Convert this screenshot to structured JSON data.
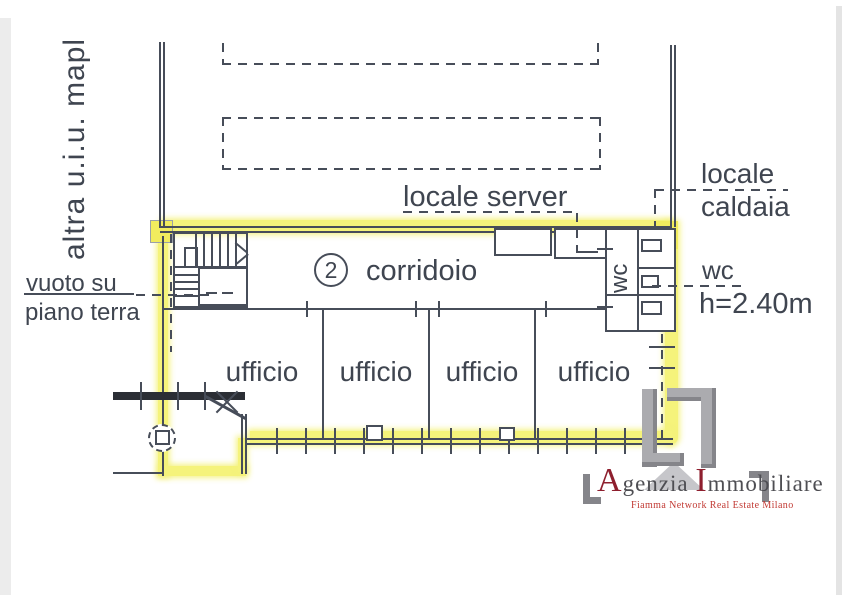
{
  "colors": {
    "highlight": "#f5f37b",
    "line": "#474d59",
    "logo_red": "#8e1f2e",
    "logo_sub": "#c23a34"
  },
  "plan": {
    "side_label": "altra u.i.u. mapl",
    "vuoto_line1": "vuoto su",
    "vuoto_line2": "piano terra",
    "locale_server_label": "locale server",
    "locale_caldaia_line1": "locale",
    "locale_caldaia_line2": "caldaia",
    "corridor_number": "2",
    "corridor_label": "corridoio",
    "wc_room_label": "wc",
    "wc_note_label": "wc",
    "wc_note_height": "h=2.40m",
    "offices": [
      "ufficio",
      "ufficio",
      "ufficio",
      "ufficio"
    ]
  },
  "logo": {
    "initial1": "A",
    "part1": "genzia ",
    "initial2": "I",
    "part2": "mmobiliare",
    "subtitle": "Fiamma Network  Real Estate  Milano"
  }
}
